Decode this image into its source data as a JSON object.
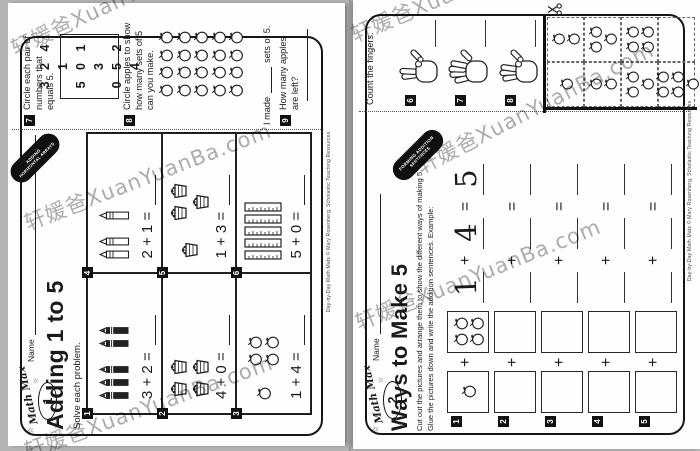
{
  "watermark": {
    "text": "轩媛爸XuanYuanBa.com"
  },
  "copyright": "Day-by-Day Math Mats © Mary Rosenberg, Scholastic Teaching Resources",
  "left_page": {
    "logo": {
      "script": "Math Max",
      "number": "1"
    },
    "name_label": "Name",
    "title": "Adding 1 to 5",
    "subtitle": "Solve each problem.",
    "tab_label": {
      "line1": "ADDING",
      "line2": "HORIZONTAL ARRAYS"
    },
    "problems": [
      {
        "num": "1",
        "icon": "crayon-dark",
        "groups": [
          3,
          2
        ],
        "equation": "3 + 2 ="
      },
      {
        "num": "2",
        "icon": "basket",
        "groups": [
          4
        ],
        "equation": "4 + 0 ="
      },
      {
        "num": "3",
        "icon": "apple",
        "groups": [
          1,
          4
        ],
        "equation": "1 + 4 ="
      },
      {
        "num": "4",
        "icon": "crayon-light",
        "groups": [
          2,
          1
        ],
        "equation": "2 + 1 ="
      },
      {
        "num": "5",
        "icon": "basket",
        "groups": [
          1,
          3
        ],
        "equation": "1 + 3 ="
      },
      {
        "num": "6",
        "icon": "ruler",
        "groups": [
          5
        ],
        "equation": "5 + 0 ="
      }
    ],
    "section7": {
      "num": "7",
      "text": [
        "Circle each pair of",
        "numbers that",
        "equals 5."
      ],
      "number_grid": [
        [
          "3",
          "2",
          "4",
          "1"
        ],
        [
          "5",
          "0",
          "1",
          "3"
        ],
        [
          "0",
          "5",
          "2",
          "4"
        ]
      ]
    },
    "section8": {
      "num": "8",
      "text": [
        "Circle apples to show",
        "how many sets of 5",
        "can you make."
      ],
      "apple_cols": 4,
      "apple_rows": 5,
      "answer_prefix": "I made",
      "answer_suffix": "sets of 5."
    },
    "section9": {
      "num": "9",
      "text": [
        "How many apples",
        "are left?"
      ]
    }
  },
  "right_page": {
    "logo": {
      "script": "Math Max",
      "number": "2"
    },
    "name_label": "Name",
    "title": "Ways to Make 5",
    "instructions": [
      "Cut out the pictures and arrange them to show the different ways of making 5.",
      "Glue the pictures down and write the addition sentences. Example:"
    ],
    "tab_label": {
      "line1": "FORMING ADDITION",
      "line2": "SENTENCES"
    },
    "rows": [
      {
        "num": "1",
        "box1_apples": 1,
        "box2_apples": 4,
        "written": [
          "1",
          "4",
          "5"
        ]
      },
      {
        "num": "2",
        "box1_apples": 0,
        "box2_apples": 0,
        "written": [
          "",
          "",
          ""
        ]
      },
      {
        "num": "3",
        "box1_apples": 0,
        "box2_apples": 0,
        "written": [
          "",
          "",
          ""
        ]
      },
      {
        "num": "4",
        "box1_apples": 0,
        "box2_apples": 0,
        "written": [
          "",
          "",
          ""
        ]
      },
      {
        "num": "5",
        "box1_apples": 0,
        "box2_apples": 0,
        "written": [
          "",
          "",
          ""
        ]
      }
    ],
    "fingers_section": {
      "heading": "Count the fingers.",
      "items": [
        {
          "num": "6",
          "fingers": 2
        },
        {
          "num": "7",
          "fingers": 5
        },
        {
          "num": "8",
          "fingers": 3
        }
      ]
    },
    "cutout_cells": [
      [
        1,
        2
      ],
      [
        2,
        3
      ],
      [
        3,
        4
      ],
      [
        5,
        0
      ]
    ]
  }
}
